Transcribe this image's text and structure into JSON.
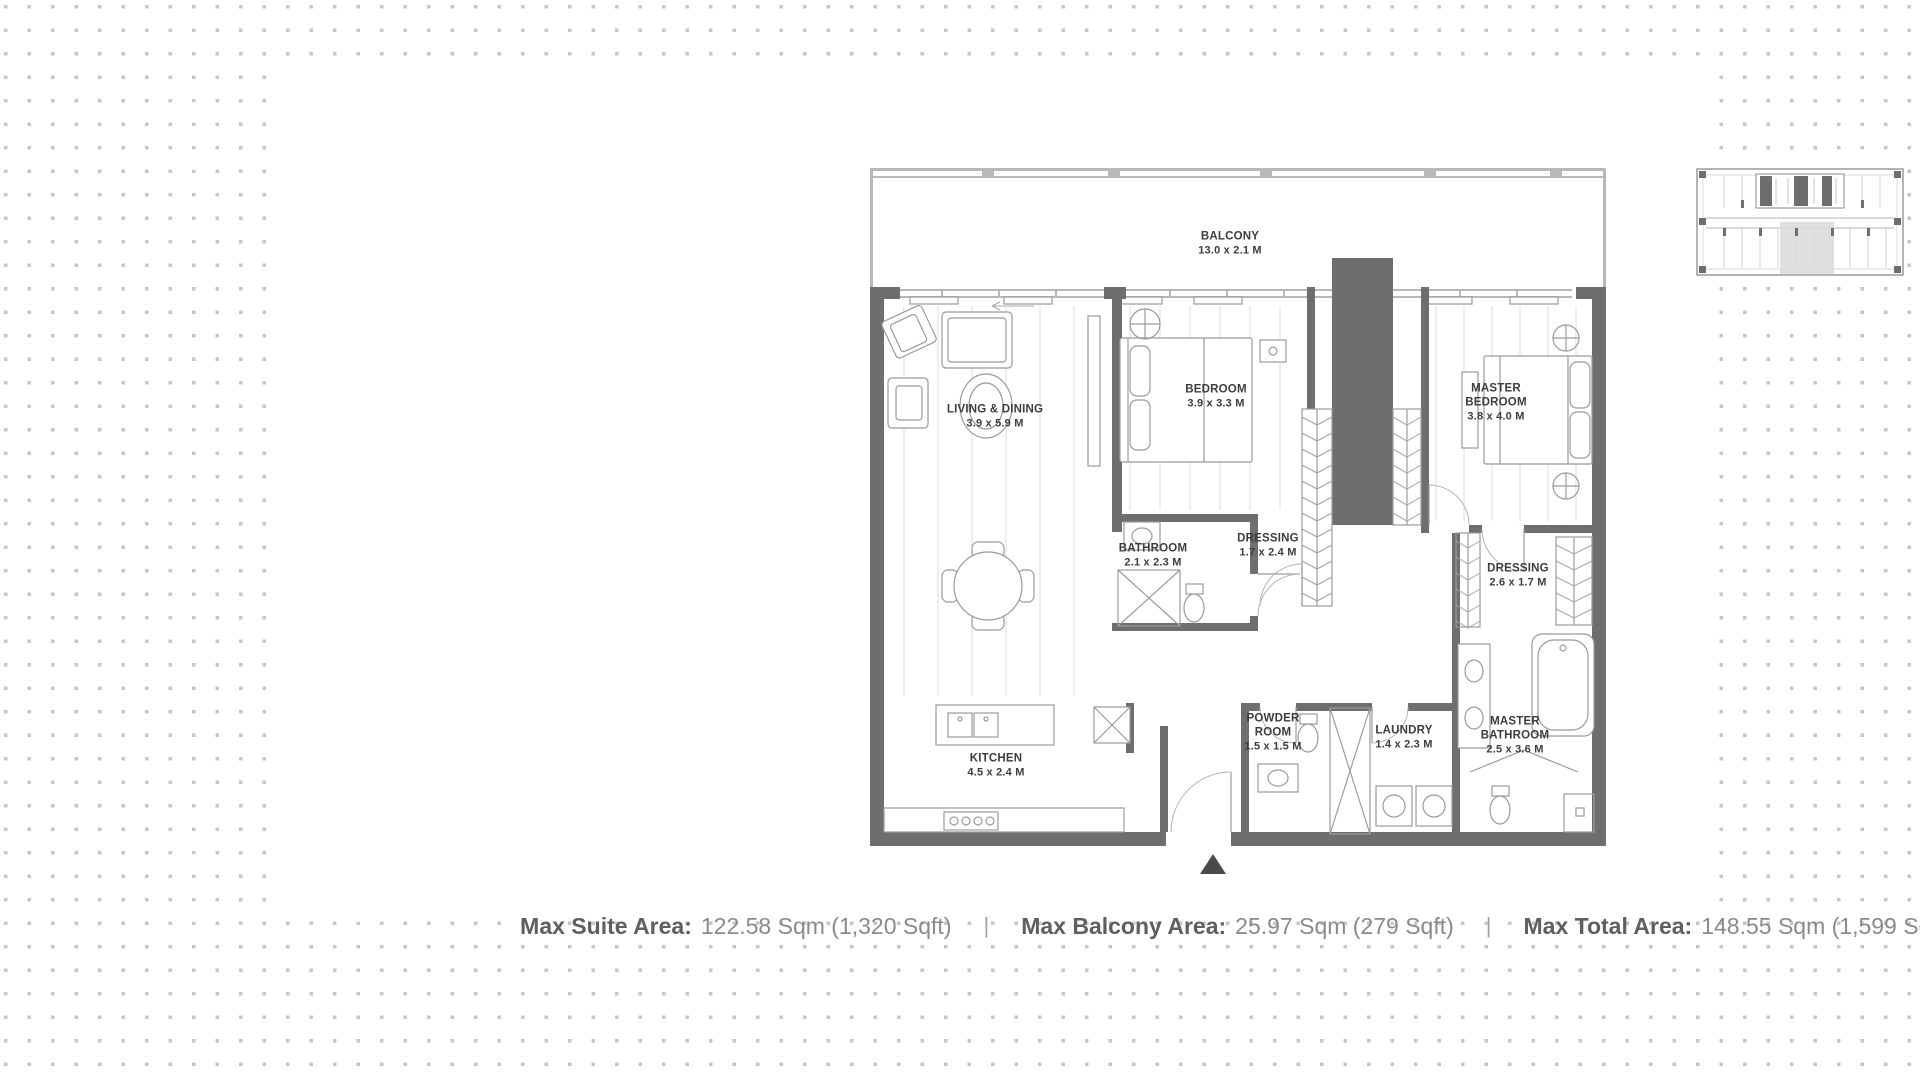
{
  "colors": {
    "wall": "#6e6e6e",
    "background_dots": "#c6c6c6",
    "key_plan_highlight": "#d9d9d9",
    "room_label_text": "#3d3d3d",
    "stats_label_text": "#5f5f5f",
    "stats_value_text": "#8a8a8a"
  },
  "floor_plan": {
    "rooms": [
      {
        "id": "balcony",
        "name": "BALCONY",
        "dims": "13.0 x 2.1 M"
      },
      {
        "id": "living_dining",
        "name": "LIVING & DINING",
        "dims": "3.9 x 5.9 M"
      },
      {
        "id": "bedroom",
        "name": "BEDROOM",
        "dims": "3.9 x 3.3 M"
      },
      {
        "id": "master_bedroom",
        "name": "MASTER BEDROOM",
        "dims": "3.8 x 4.0 M"
      },
      {
        "id": "bathroom",
        "name": "BATHROOM",
        "dims": "2.1 x 2.3 M"
      },
      {
        "id": "dressing_1",
        "name": "DRESSING",
        "dims": "1.7 x 2.4 M"
      },
      {
        "id": "dressing_2",
        "name": "DRESSING",
        "dims": "2.6 x 1.7 M"
      },
      {
        "id": "kitchen",
        "name": "KITCHEN",
        "dims": "4.5 x 2.4 M"
      },
      {
        "id": "powder_room",
        "name": "POWDER ROOM",
        "dims": "1.5 x 1.5 M"
      },
      {
        "id": "laundry",
        "name": "LAUNDRY",
        "dims": "1.4 x 2.3 M"
      },
      {
        "id": "master_bathroom",
        "name": "MASTER BATHROOM",
        "dims": "2.5 x 3.6 M"
      }
    ]
  },
  "areas": {
    "separator": "|",
    "suite": {
      "label": "Max Suite Area:",
      "value": "122.58 Sqm (1,320 Sqft)"
    },
    "balcony": {
      "label": "Max Balcony Area:",
      "value": "25.97 Sqm (279 Sqft)"
    },
    "total": {
      "label": "Max Total Area:",
      "value": "148.55 Sqm (1,599 Sqft)"
    }
  }
}
